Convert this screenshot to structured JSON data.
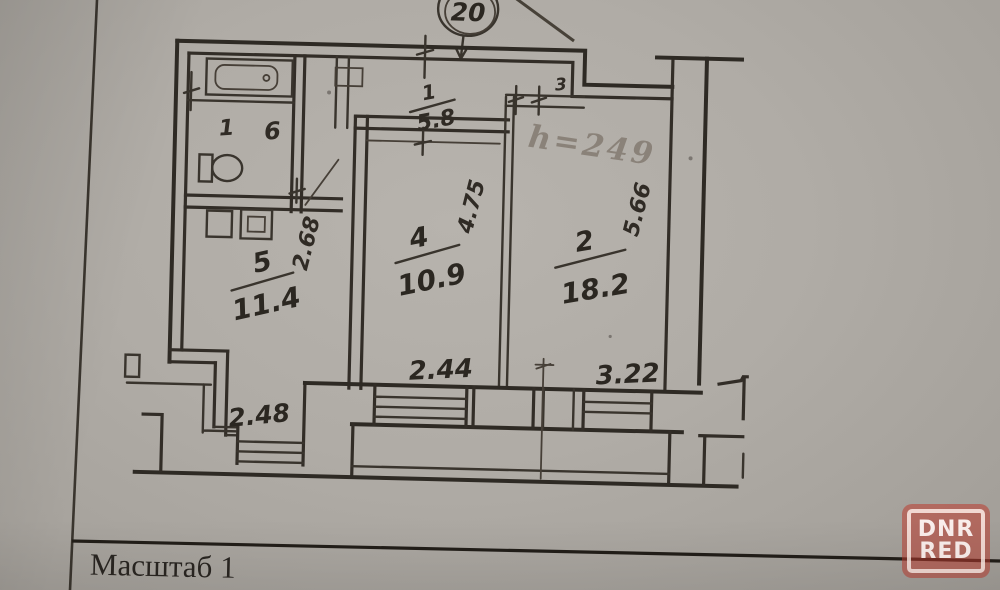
{
  "document": {
    "type": "apartment floor plan photo"
  },
  "footer": {
    "caption": "Масштаб 1"
  },
  "annotations": {
    "plan_circle": "20",
    "height": "h=249"
  },
  "rooms": {
    "kitchen": {
      "number": "5",
      "area": "11.4"
    },
    "living": {
      "number": "4",
      "area": "10.9"
    },
    "bedroom": {
      "number": "2",
      "area": "18.2"
    },
    "wc": {
      "number": "1"
    },
    "bath": {
      "number": "6"
    },
    "hall": {
      "number": "3"
    }
  },
  "dims": {
    "top_whole": "1",
    "top": "5.8",
    "kitchen_v": "2.68",
    "living_v": "4.75",
    "bedroom_v": "5.66",
    "living_w": "2.44",
    "bedroom_w": "3.22",
    "kitchen_w": "2.48"
  },
  "watermark": {
    "top": "DNR",
    "bottom": "RED",
    "color": "#bc3c2f"
  },
  "colors": {
    "ink": "#2e2a24",
    "paper": "#b0aca6"
  }
}
